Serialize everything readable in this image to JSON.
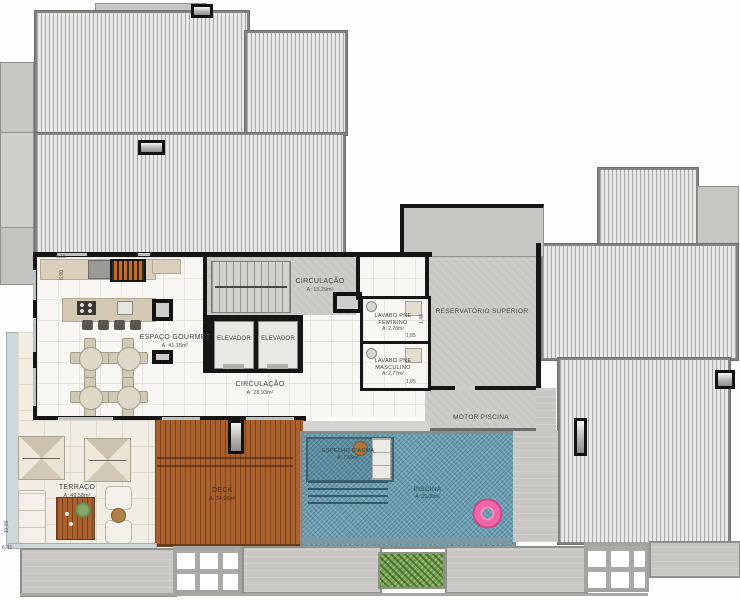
{
  "rooms": {
    "gourmet": {
      "name": "ESPAÇO GOURMET",
      "area": "A: 41,18m²"
    },
    "circulacao_top": {
      "name": "CIRCULAÇÃO",
      "area": "A: 15,29m²"
    },
    "circulacao_main": {
      "name": "CIRCULAÇÃO",
      "area": "A: 28,93m²"
    },
    "elevador_1": {
      "name": "ELEVADOR"
    },
    "elevador_2": {
      "name": "ELEVADOR"
    },
    "lavabo_fem": {
      "name_line1": "LAVABO PNE",
      "name_line2": "FEMININO",
      "area": "A: 2,78m²"
    },
    "lavabo_masc": {
      "name_line1": "LAVABO PNE",
      "name_line2": "MASCULINO",
      "area": "A: 2,77m²"
    },
    "reservatorio": {
      "name": "RESERVATÓRIO SUPERIOR"
    },
    "motor_piscina": {
      "name": "MOTOR PISCINA"
    },
    "terraco": {
      "name": "TERRAÇO",
      "area": "A: 49,58m²"
    },
    "deck": {
      "name": "DECK",
      "area": "A: 34,96m²"
    },
    "piscina": {
      "name": "PISCINA",
      "area": "A: 39,06m²"
    },
    "espelho_dagua": {
      "name": "ESPELHO D'ÁGUA",
      "area": "A: 7,56m²"
    }
  },
  "dimensions": {
    "top_left_width": "6,15",
    "top_left_height": "6,90",
    "lavabo_height": "1,48",
    "lavabo_fem_width": "1,85",
    "lavabo_masc_width": "1,85",
    "terrace_height": "10,15",
    "terrace_width": "6,43"
  },
  "colors": {
    "pool_water": "#6d9fb2",
    "deck_wood": "#a9622f",
    "float_pink": "#f06fad",
    "garden_green": "#76a052",
    "wall_black": "#161616",
    "roof_stripe": "#e8e8e6",
    "concrete": "#c8c7c3"
  }
}
